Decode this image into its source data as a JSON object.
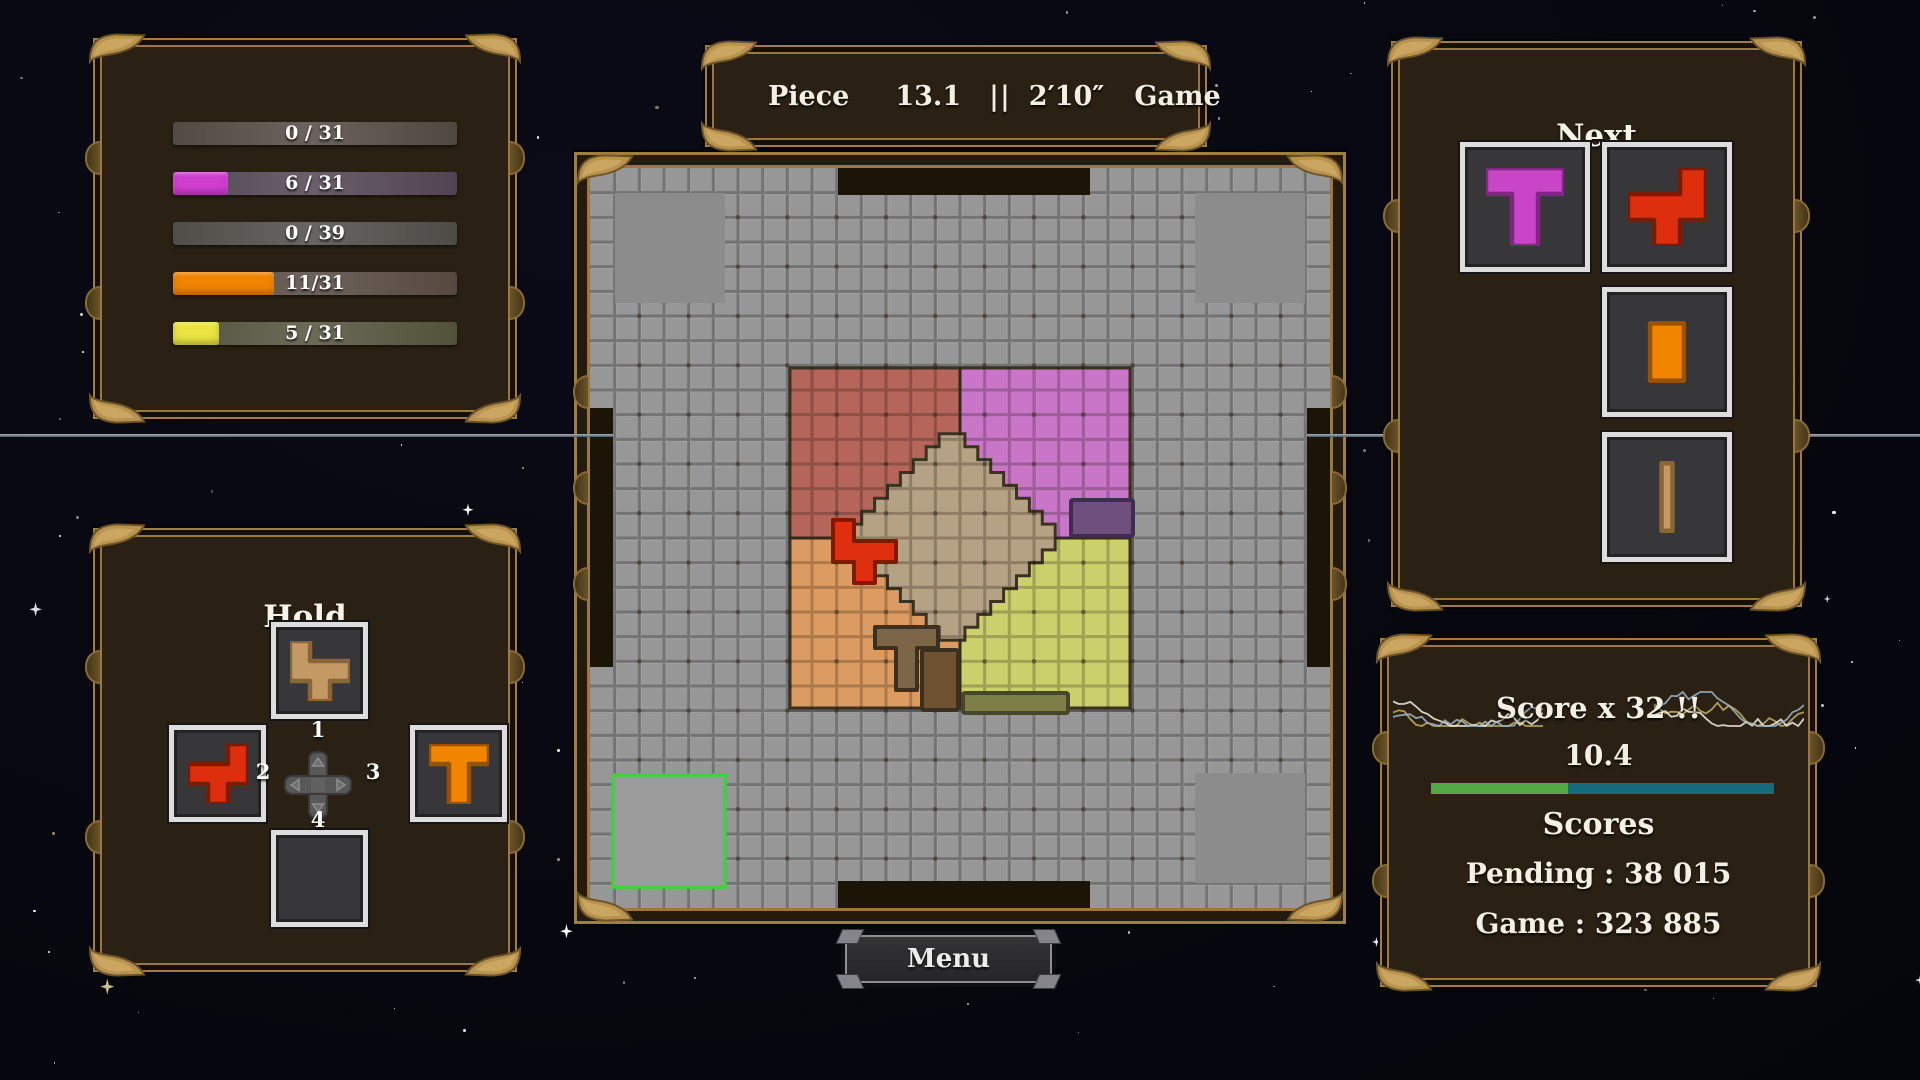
{
  "progress_panel": {
    "bars": [
      {
        "label": "0 / 31",
        "ratio": 0,
        "fill": "#cf3ecf",
        "track": "#4a4039"
      },
      {
        "label": "6 / 31",
        "ratio": 0.194,
        "fill": "#cf3ecf",
        "track": "#4b3c4b"
      },
      {
        "label": "0 / 39",
        "ratio": 0,
        "fill": "#f08400",
        "track": "#45443f"
      },
      {
        "label": "11/31",
        "ratio": 0.355,
        "fill": "#f08400",
        "track": "#4e4138"
      },
      {
        "label": "5 / 31",
        "ratio": 0.161,
        "fill": "#e9e441",
        "track": "#4b4a33"
      }
    ]
  },
  "timer_panel": {
    "piece_label": "Piece",
    "piece_time": "13.1",
    "separator": "||",
    "game_time": "2′10″",
    "game_label": "Game"
  },
  "next_panel": {
    "title": "Next",
    "pieces": [
      {
        "shape": "t",
        "fill": "#c845c8",
        "stroke": "#832683"
      },
      {
        "shape": "s_right",
        "fill": "#dd2e0e",
        "stroke": "#7d1a00"
      },
      {
        "shape": "domino",
        "fill": "#f18500",
        "stroke": "#9b5200"
      },
      {
        "shape": "ibar",
        "fill": "#c49a64",
        "stroke": "#8a6636"
      }
    ]
  },
  "hold_panel": {
    "title": "Hold",
    "pieces": {
      "top": {
        "shape": "s_left",
        "fill": "#c49a64",
        "stroke": "#8a6636"
      },
      "left": {
        "shape": "s_right",
        "fill": "#dd2e0e",
        "stroke": "#7d1a00"
      },
      "right": {
        "shape": "t",
        "fill": "#f18500",
        "stroke": "#9b5200"
      }
    },
    "dpad": {
      "up": "1",
      "left": "2",
      "right": "3",
      "down": "4"
    }
  },
  "score_panel": {
    "title": "Score x 32  !!",
    "value": "10.4",
    "bar": {
      "ratio_green": 0.4,
      "green": "#55a944",
      "teal": "#156a7d"
    },
    "scores_heading": "Scores",
    "pending_line": "Pending : 38 015",
    "game_line": "Game : 323 885"
  },
  "menu_button": {
    "label": "Menu"
  },
  "shapes": {
    "t": "M0,0 H3 V1 H2 V3 H1 V1 H0 Z",
    "s_right": "M2,0 H3 V2 H2 V3 H1 V2 H0 V1 H2 Z",
    "s_left": "M0,0 H1 V1 H3 V2 H2 V3 H1 V2 H0 Z",
    "domino": "rect:0.85,0.4,1.3,2.2",
    "ibar": "rect:1.29,0.2,0.42,2.6"
  },
  "board": {
    "size": 740,
    "cells": 30,
    "cell": 24.667,
    "colors": {
      "base": "#979797",
      "grid_line": "#4f4f4f",
      "grid_dot": "#2b2417",
      "region_stroke": "#3c3222",
      "notch": "#1c1507",
      "corner_square": "#8c8c8c",
      "start_fill": "#9b9b9b",
      "start_border": "#3fd23f"
    },
    "corner_squares": [
      {
        "x": 25,
        "y": 25
      },
      {
        "x": 605,
        "y": 25
      },
      {
        "x": 605,
        "y": 605
      }
    ],
    "corner_square_size": 110,
    "start_square": {
      "x": 23,
      "y": 607,
      "size": 112
    },
    "quadrants": [
      {
        "name": "red",
        "x": 200,
        "y": 200,
        "w": 170,
        "h": 170,
        "color": "#b5655a"
      },
      {
        "name": "magenta",
        "x": 370,
        "y": 200,
        "w": 170,
        "h": 170,
        "color": "#c976c9"
      },
      {
        "name": "orange",
        "x": 200,
        "y": 370,
        "w": 170,
        "h": 170,
        "color": "#dc9b61"
      },
      {
        "name": "yellow",
        "x": 370,
        "y": 370,
        "w": 170,
        "h": 170,
        "color": "#ccd06c"
      }
    ],
    "diamond": {
      "cx": 362,
      "cy": 369,
      "step": 12.9,
      "steps": 8,
      "color": "#b5a183"
    },
    "placed_pieces": [
      {
        "type": "path",
        "shape": "s_left",
        "x": 243,
        "y": 352,
        "u": 21,
        "fill": "#df2f0e",
        "stroke": "#7d1a00"
      },
      {
        "type": "path",
        "shape": "t",
        "x": 285,
        "y": 459,
        "u": 21,
        "fill": "#7d6547",
        "stroke": "#3c3020"
      },
      {
        "type": "rect",
        "x": 332,
        "y": 482,
        "w": 36,
        "h": 60,
        "fill": "#6f5231",
        "stroke": "#3c3020"
      },
      {
        "type": "rect",
        "x": 373,
        "y": 525,
        "w": 105,
        "h": 20,
        "fill": "#7e7e48",
        "stroke": "#46462a"
      },
      {
        "type": "rect",
        "x": 481,
        "y": 332,
        "w": 62,
        "h": 36,
        "fill": "#6e4f7e",
        "stroke": "#3f2c4e"
      }
    ],
    "notches": [
      {
        "x": 248,
        "y": 0,
        "w": 252,
        "h": 27
      },
      {
        "x": 248,
        "y": 713,
        "w": 252,
        "h": 27
      },
      {
        "x": 0,
        "y": 240,
        "w": 23,
        "h": 259
      },
      {
        "x": 717,
        "y": 240,
        "w": 23,
        "h": 259
      }
    ]
  }
}
